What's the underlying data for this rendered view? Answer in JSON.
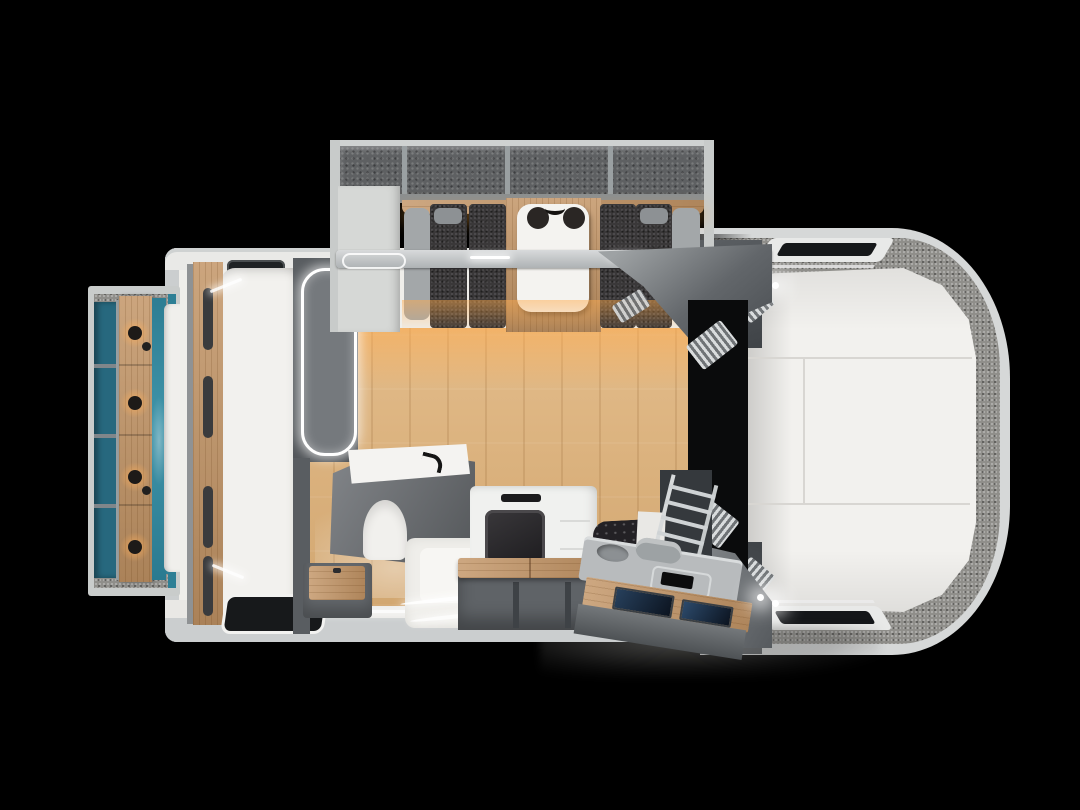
{
  "meta": {
    "content_type": "3d-rendered floorplan, top view",
    "subject": "truck camper RV interior layout",
    "canvas": {
      "width": 1080,
      "height": 810
    },
    "visible_text": "none"
  },
  "palette": {
    "bg": "#000000",
    "rim": "#d6d8d8",
    "rim_light": "#e8e9e8",
    "wall_white": "#efeeea",
    "wall_grey": "#cbcecf",
    "dark_wall": "#54585c",
    "darker_wall": "#3f4347",
    "charcoal": "#3a3839",
    "carpet": "#8f8e8a",
    "speckle_dark_base": "#5e6062",
    "teal": "#2e7f95",
    "teal_deep": "#27687e",
    "wood_floor_base": "#d9b27f",
    "wood_furn_base": "#c29465",
    "warm_glow": "#ffab4d",
    "mattress": "#f2f1ee",
    "seam": "#d8d6d2",
    "black_hole": "#0a0b0c",
    "screen_blue": "#2c4a6b",
    "led": "#ffffff"
  },
  "scene": {
    "rear_bedroom_slideout": {
      "position": "left",
      "items": [
        "storage-cubbies",
        "wood-headboard",
        "sconce-light x4",
        "teal-accent-wall",
        "mattress-edge",
        "carpet-strips"
      ]
    },
    "main_cabin": {
      "position": "center",
      "items": [
        "rear-bed",
        "wardrobe-slat-column",
        "ceiling-vent",
        "rear-window",
        "led-framed-partition",
        "wet-bath (vanity, faucet, toilet, shower-tray)",
        "wood-step-stool",
        "oven-appliance",
        "bench-seat-wood-top",
        "tufted-cushion",
        "oak-plank-floor",
        "led-accent-strips"
      ]
    },
    "dinette_slideout": {
      "position": "top",
      "items": [
        "overhead-open-shelves x4",
        "wood-light-shelf",
        "side-cabinet",
        "bench-sofa x2 (charcoal cushions, grey armrests, pillows)",
        "white-dining-table",
        "table-decor-bowls x2",
        "wood-platform",
        "under-bench-warm-glow"
      ]
    },
    "entry_galley": {
      "position": "bottom-right",
      "items": [
        "console (sink, rolled-towel, tray)",
        "wood-step-board",
        "control-screen x2",
        "access-ladder",
        "exterior-light",
        "ground-shadow"
      ]
    },
    "cab_passage": {
      "position": "center-right",
      "items": [
        "dark-passage",
        "air-grille x2",
        "grey-bulkhead-wedge x2"
      ]
    },
    "cabover_bed": {
      "position": "right (vehicle nose)",
      "items": [
        "outer-shell-rim",
        "carpet-surround",
        "three-panel-mattress",
        "mattress-seams",
        "skylight-window-top",
        "skylight-window-bottom",
        "reading-light x2",
        "side-wardrobe-column x2",
        "step-slats x2"
      ]
    }
  }
}
